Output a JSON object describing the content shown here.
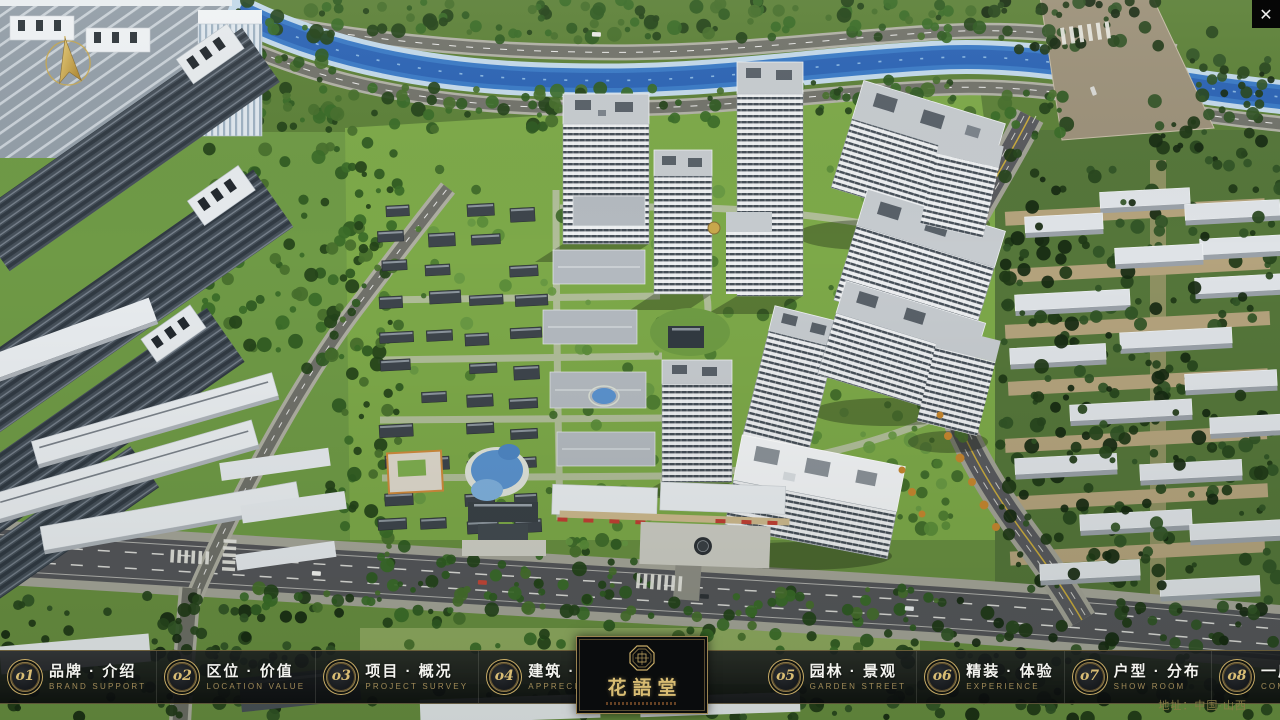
{
  "app": {
    "close_glyph": "✕"
  },
  "logo": {
    "title": "花語堂"
  },
  "nav": {
    "left_items": [
      {
        "num": "o1",
        "zh": "品牌 · 介绍",
        "en": "BRAND SUPPORT"
      },
      {
        "num": "o2",
        "zh": "区位 · 价值",
        "en": "LOCATION VALUE"
      },
      {
        "num": "o3",
        "zh": "项目 · 概况",
        "en": "PROJECT SURVEY"
      },
      {
        "num": "o4",
        "zh": "建筑 · 鉴赏",
        "en": "APPRECIATION"
      }
    ],
    "right_items": [
      {
        "num": "o5",
        "zh": "园林 · 景观",
        "en": "GARDEN STREET"
      },
      {
        "num": "o6",
        "zh": "精装 · 体验",
        "en": "EXPERIENCE"
      },
      {
        "num": "o7",
        "zh": "户型 · 分布",
        "en": "SHOW ROOM"
      },
      {
        "num": "o8",
        "zh": "一房 · 一景",
        "en": "COMMUNITY"
      }
    ]
  },
  "footer": {
    "address": "地址：中国·山西"
  },
  "colors": {
    "accent_gold": "#c9ad67",
    "bar_background": "rgba(16,18,20,0.88)"
  }
}
